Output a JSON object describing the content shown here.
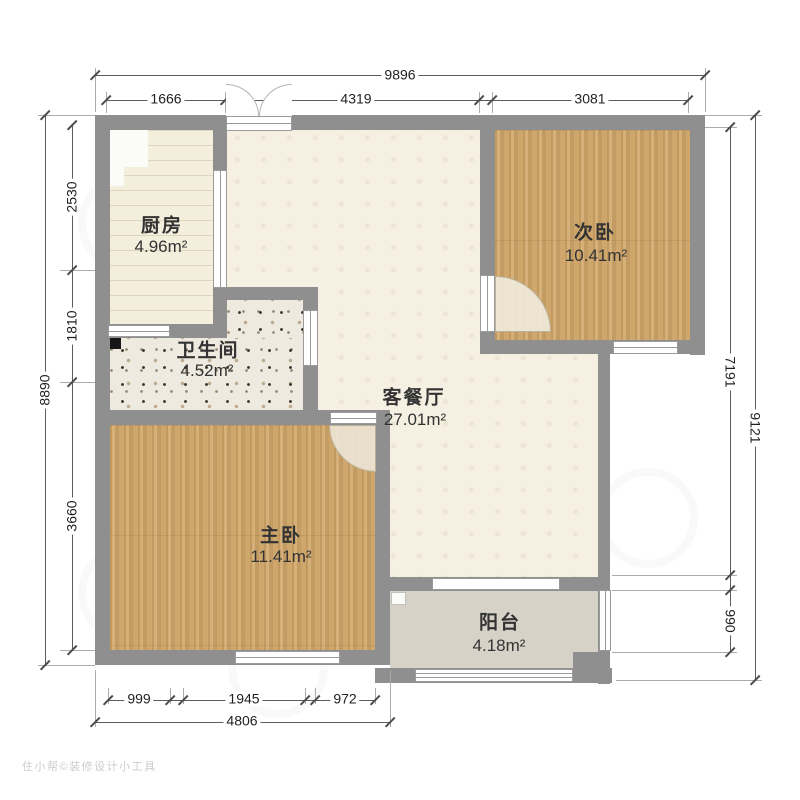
{
  "rooms": [
    {
      "id": "kitchen",
      "name": "厨房",
      "area": "4.96m²"
    },
    {
      "id": "bathroom",
      "name": "卫生间",
      "area": "4.52m²"
    },
    {
      "id": "living-dining",
      "name": "客餐厅",
      "area": "27.01m²"
    },
    {
      "id": "second-bedroom",
      "name": "次卧",
      "area": "10.41m²"
    },
    {
      "id": "master-bedroom",
      "name": "主卧",
      "area": "11.41m²"
    },
    {
      "id": "balcony",
      "name": "阳台",
      "area": "4.18m²"
    }
  ],
  "dimensions": {
    "top": {
      "total": "9896",
      "segments": [
        "1666",
        "4319",
        "3081"
      ]
    },
    "left": {
      "total": "8890",
      "segments": [
        "2530",
        "1810",
        "3660"
      ]
    },
    "right": {
      "total": "9121",
      "segments": [
        "7191",
        "990"
      ]
    },
    "bottom": {
      "total": "4806",
      "segments": [
        "999",
        "1945",
        "972"
      ]
    }
  },
  "watermark": {
    "text": "住小帮©装修设计小工具"
  },
  "palette": {
    "wall": "#8f8f8f",
    "wood_floor": "#cfa76d",
    "kitchen_floor": "#f4eedd",
    "bathroom_floor": "#efeadf",
    "living_floor": "#f5f0e2",
    "balcony_floor": "#d6d2c7",
    "dimension_line": "#5c5c5c",
    "label_text": "#333333"
  }
}
